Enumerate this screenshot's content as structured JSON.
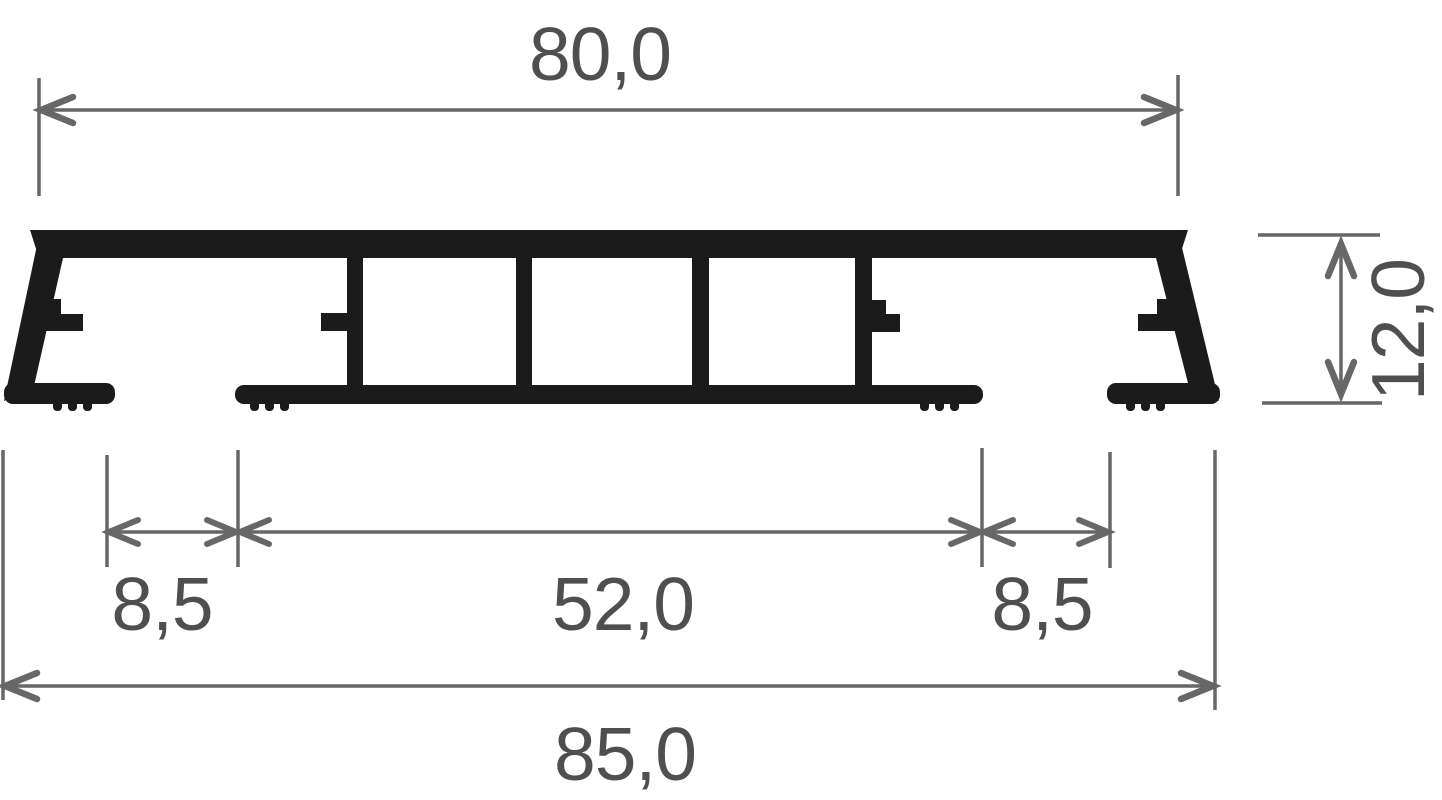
{
  "drawing": {
    "labels": {
      "top_width": "80,0",
      "height": "12,0",
      "left_gap": "8,5",
      "center_width": "52,0",
      "right_gap": "8,5",
      "bottom_width": "85,0"
    },
    "colors": {
      "profile": "#1b1b1b",
      "dim_lines": "#676767",
      "dim_text": "#4f4f4f",
      "background": "#ffffff"
    }
  }
}
